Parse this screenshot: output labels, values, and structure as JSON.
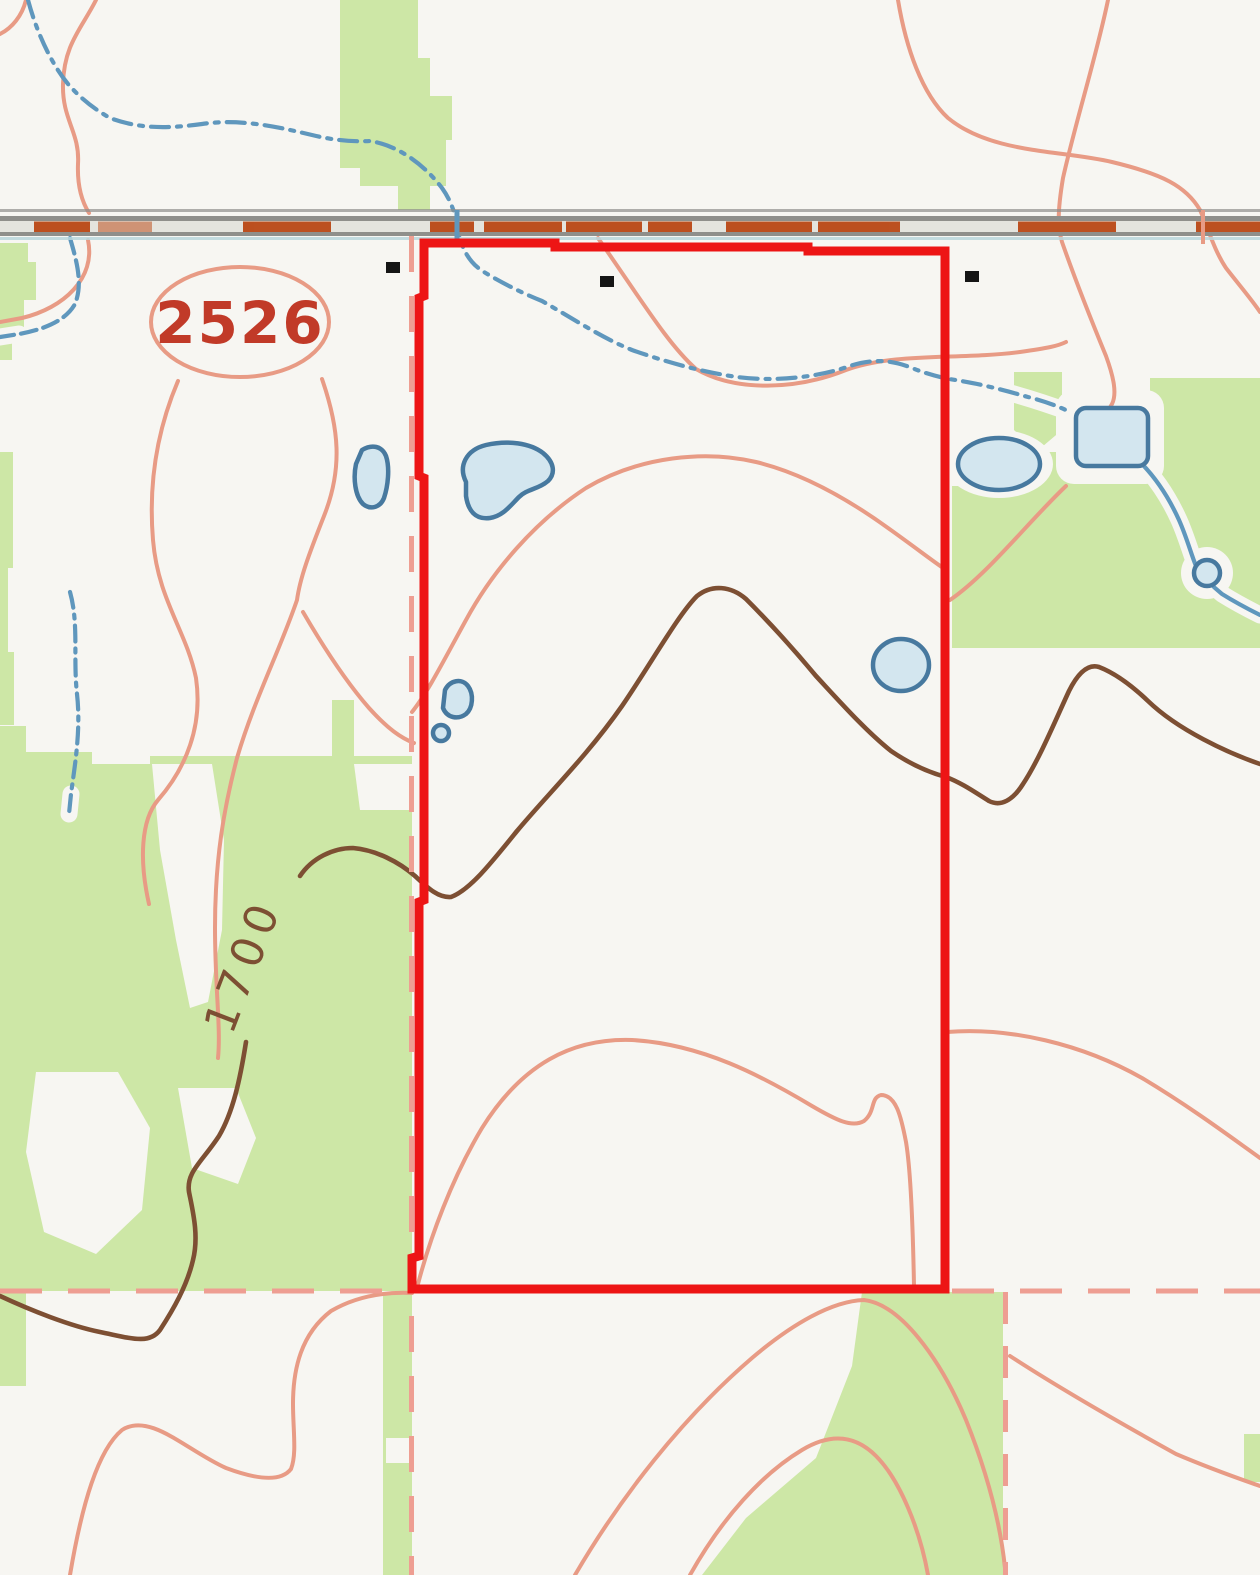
{
  "map": {
    "description": "USGS-style topographic quad with red parcel boundary overlay",
    "labels": {
      "route_shield": "2526",
      "index_contour_elevation": "1700"
    },
    "colors": {
      "background": "#f7f6f2",
      "vegetation": "#cde7a6",
      "contour": "#e89b85",
      "index_contour": "#7d4f33",
      "water": "#5f97bd",
      "pond_fill": "#d3e6ef",
      "pond_stroke": "#47799f",
      "road_dash": "#b9430f",
      "road_gray": "#8f8f8b",
      "road_center": "#e4e4de",
      "road_blue_edge": "#b9d6dc",
      "section_line": "#ee9e92",
      "boundary_red": "#ed1515",
      "shield_text": "#c13a28",
      "corner_dot": "#151515"
    },
    "markers": {
      "section_corners": [
        {
          "x": 386,
          "y": 262
        },
        {
          "x": 600,
          "y": 276
        },
        {
          "x": 965,
          "y": 271
        }
      ]
    }
  }
}
